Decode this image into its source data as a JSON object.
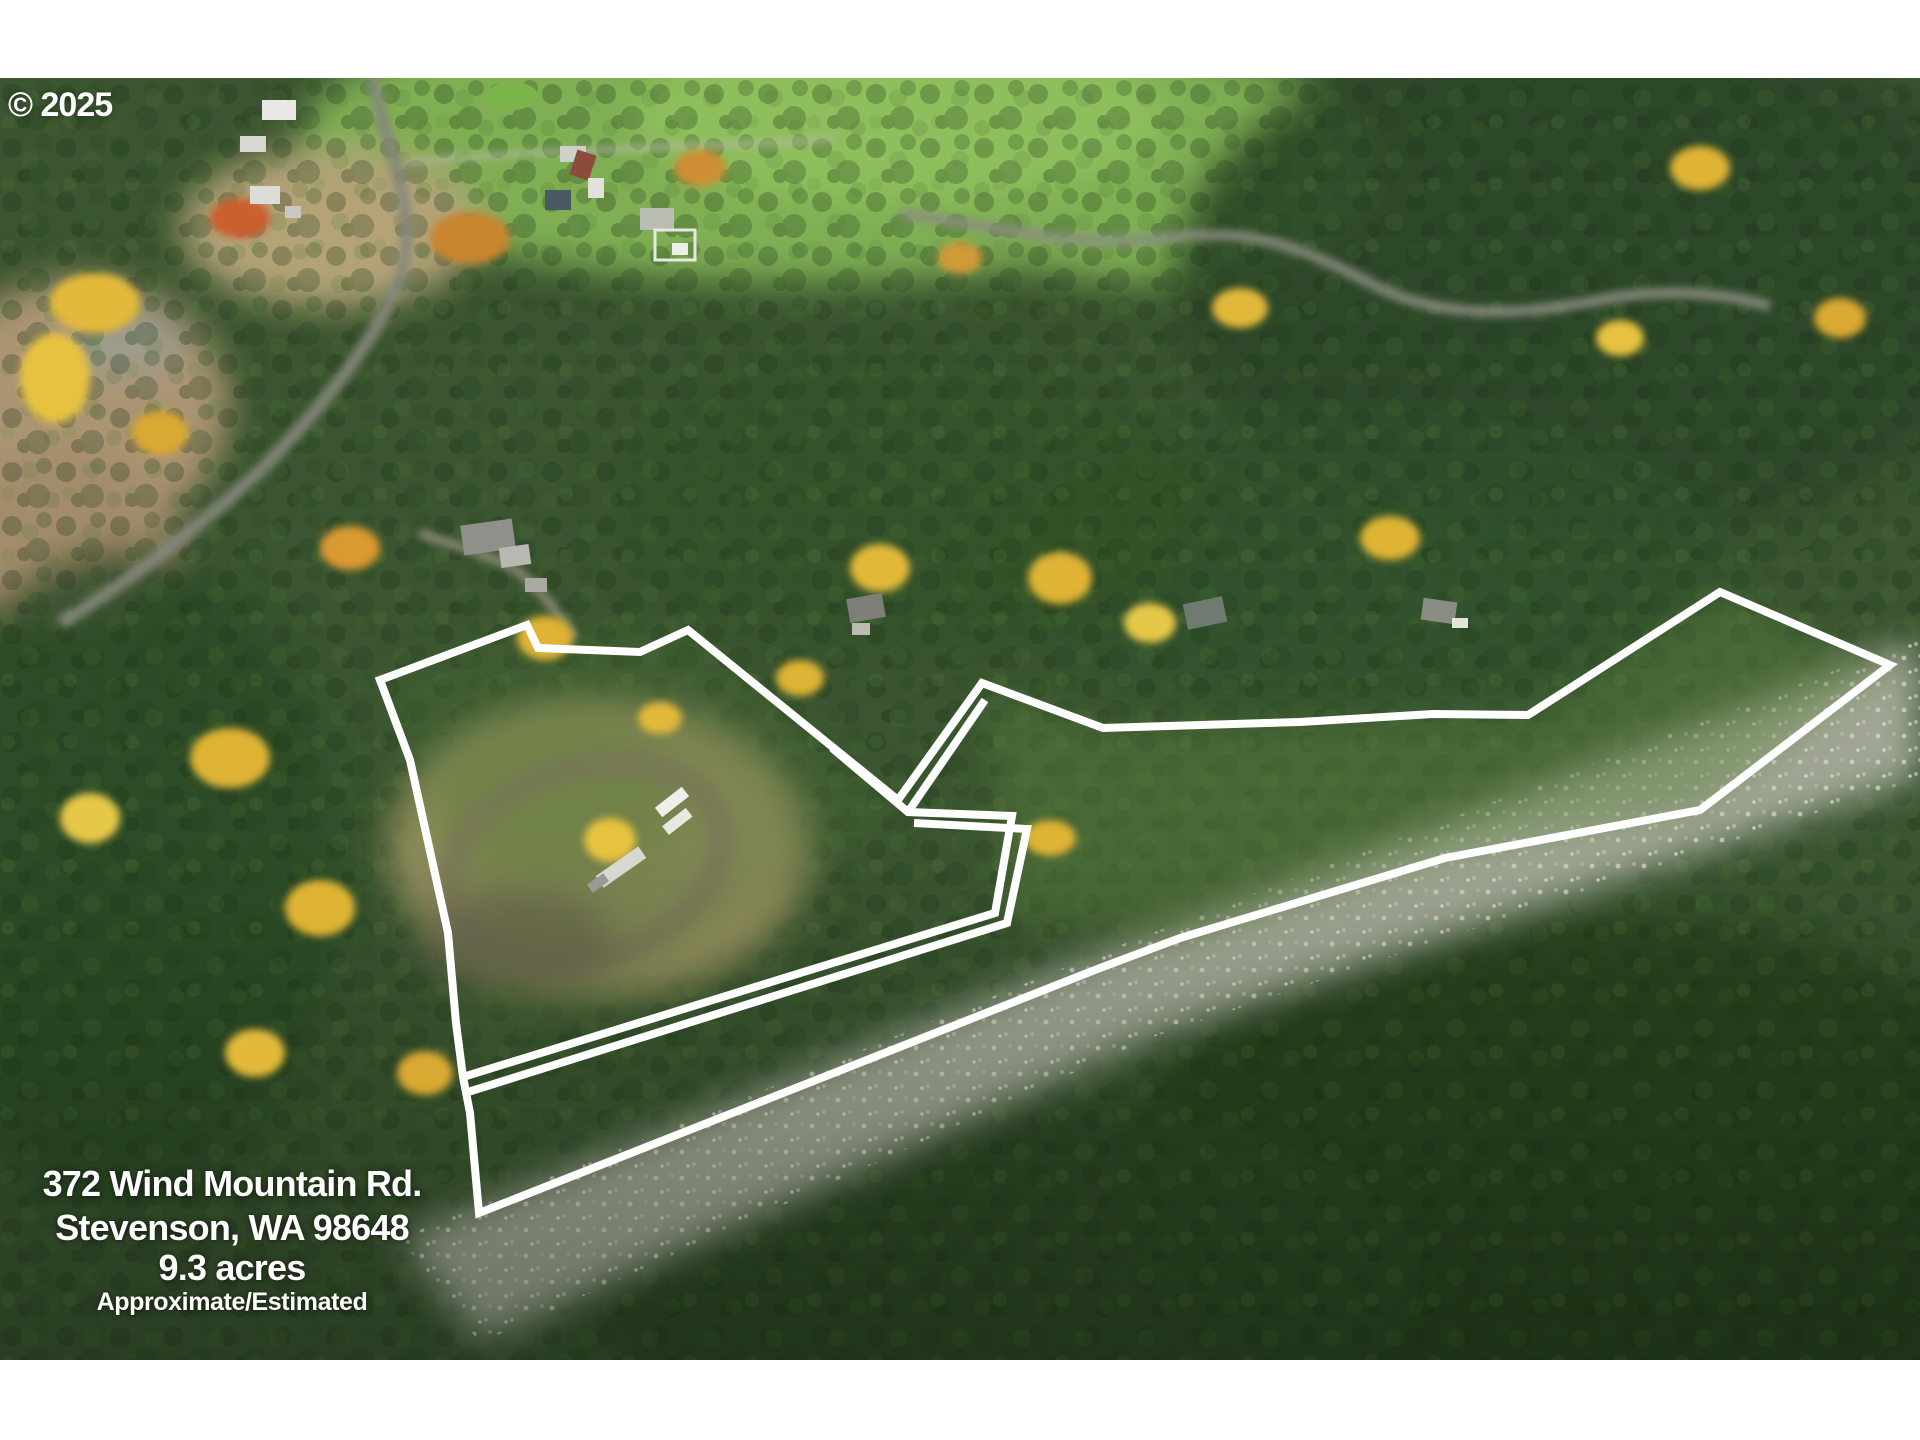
{
  "watermark": {
    "text": "© 2025"
  },
  "overlay": {
    "address_line1": "372 Wind Mountain Rd.",
    "address_line2": "Stevenson, WA 98648",
    "acreage": "9.3 acres",
    "disclaimer": "Approximate/Estimated"
  },
  "colors": {
    "boundary": "#ffffff",
    "letterbox": "#ffffff",
    "overlay_text": "#ffffff"
  },
  "boundary": {
    "stroke_width": 8,
    "main_loop": [
      [
        380,
        680
      ],
      [
        527,
        625
      ],
      [
        538,
        648
      ],
      [
        640,
        652
      ],
      [
        688,
        630
      ],
      [
        898,
        800
      ],
      [
        982,
        683
      ],
      [
        1103,
        728
      ],
      [
        1300,
        722
      ],
      [
        1433,
        714
      ],
      [
        1528,
        715
      ],
      [
        1720,
        592
      ],
      [
        1890,
        665
      ],
      [
        1700,
        810
      ],
      [
        1445,
        858
      ],
      [
        1180,
        938
      ],
      [
        1100,
        968
      ],
      [
        479,
        1213
      ],
      [
        470,
        1113
      ],
      [
        463,
        1077
      ],
      [
        456,
        1023
      ],
      [
        448,
        933
      ],
      [
        410,
        760
      ]
    ],
    "inner_return": [
      [
        832,
        748
      ],
      [
        908,
        812
      ],
      [
        1012,
        816
      ],
      [
        995,
        913
      ],
      [
        463,
        1077
      ]
    ],
    "inner_branch": [
      [
        908,
        812
      ],
      [
        985,
        700
      ]
    ],
    "parallel_line": [
      [
        914,
        823
      ],
      [
        1027,
        829
      ],
      [
        1007,
        923
      ],
      [
        468,
        1092
      ]
    ]
  }
}
